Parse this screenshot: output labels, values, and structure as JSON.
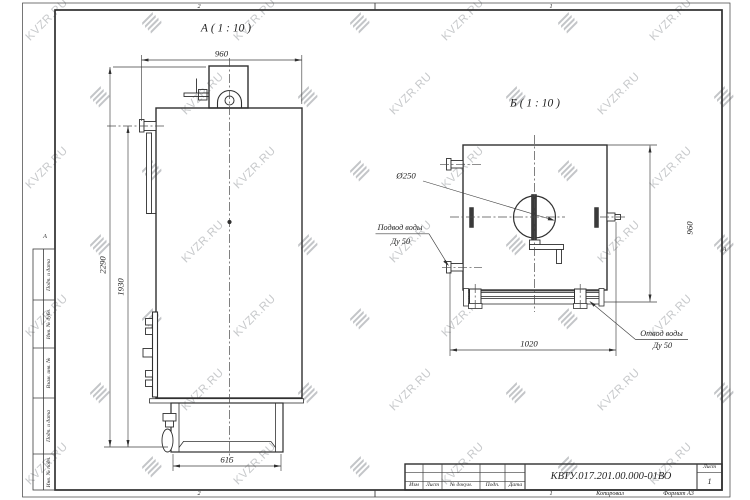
{
  "watermark": {
    "text": "KVZR.RU"
  },
  "views": {
    "a": {
      "title": "А ( 1 : 10 )",
      "dims": {
        "width_top": "960",
        "height_total": "2290",
        "height_outlet": "1930",
        "base_width": "615"
      }
    },
    "b": {
      "title": "Б ( 1 : 10 )",
      "dims": {
        "flue_diameter": "Ø250",
        "base_width": "1020",
        "height": "960"
      },
      "labels": {
        "inlet_line1": "Подвод воды",
        "inlet_line2": "Ду 50",
        "outlet_line1": "Отвод воды",
        "outlet_line2": "Ду 50"
      }
    }
  },
  "frame": {
    "zones": {
      "top_left": "2",
      "top_right": "1",
      "bottom_left": "2",
      "bottom_right": "1",
      "left": "А",
      "right": "А"
    },
    "stamp_columns": [
      "Подп. и дата",
      "Инв. № дубл.",
      "Взам. инв. №",
      "Подп. и дата",
      "Инв. № подл."
    ],
    "notes": {
      "copied_by": "Копировал",
      "format": "Формат А3"
    }
  },
  "title_block": {
    "designation": "КВТУ.017.201.00.000-01ВО",
    "columns": {
      "izm": "Изм",
      "list": "Лист",
      "doc": "№ докум.",
      "podp": "Подп.",
      "data": "Дата"
    },
    "sheet": {
      "label": "Лист",
      "number": "1"
    }
  }
}
